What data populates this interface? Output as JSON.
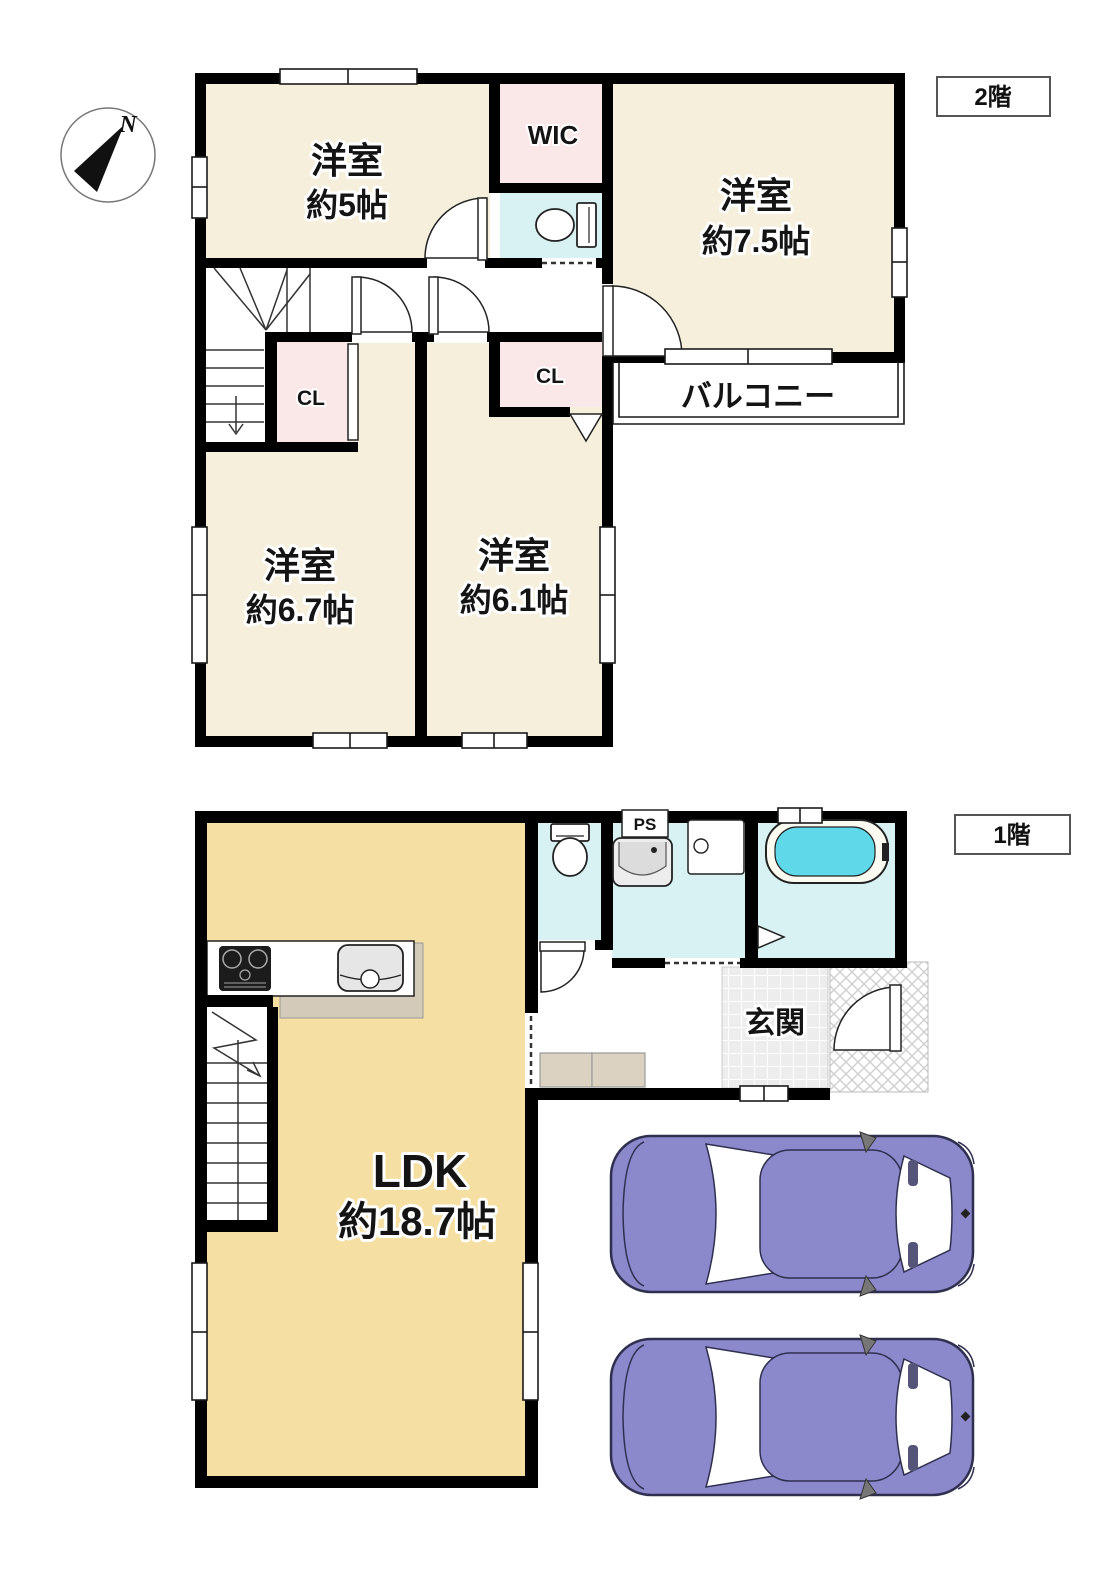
{
  "compass": {
    "north_label": "N"
  },
  "floor2": {
    "tag": "2階",
    "room_5": {
      "name": "洋室",
      "size": "約5帖"
    },
    "room_75": {
      "name": "洋室",
      "size": "約7.5帖"
    },
    "room_67": {
      "name": "洋室",
      "size": "約6.7帖"
    },
    "room_61": {
      "name": "洋室",
      "size": "約6.1帖"
    },
    "wic": "WIC",
    "closet_left": "CL",
    "closet_right": "CL",
    "balcony": "バルコニー"
  },
  "floor1": {
    "tag": "1階",
    "ldk": {
      "name": "LDK",
      "size": "約18.7帖"
    },
    "entrance": "玄関",
    "pipe_space": "PS"
  },
  "colors": {
    "wall": "#000000",
    "room_cream": "#F6EFDC",
    "closet_pink": "#FAE7E8",
    "water_cyan": "#D8F2F4",
    "tub_water": "#5FD9E9",
    "ldk_tan": "#F5DFA2",
    "counter_taupe": "#D4CABA",
    "cabinet_beige": "#DCD2C2",
    "tile_gray": "#EDEDED",
    "car_purple": "#8B88CB"
  }
}
